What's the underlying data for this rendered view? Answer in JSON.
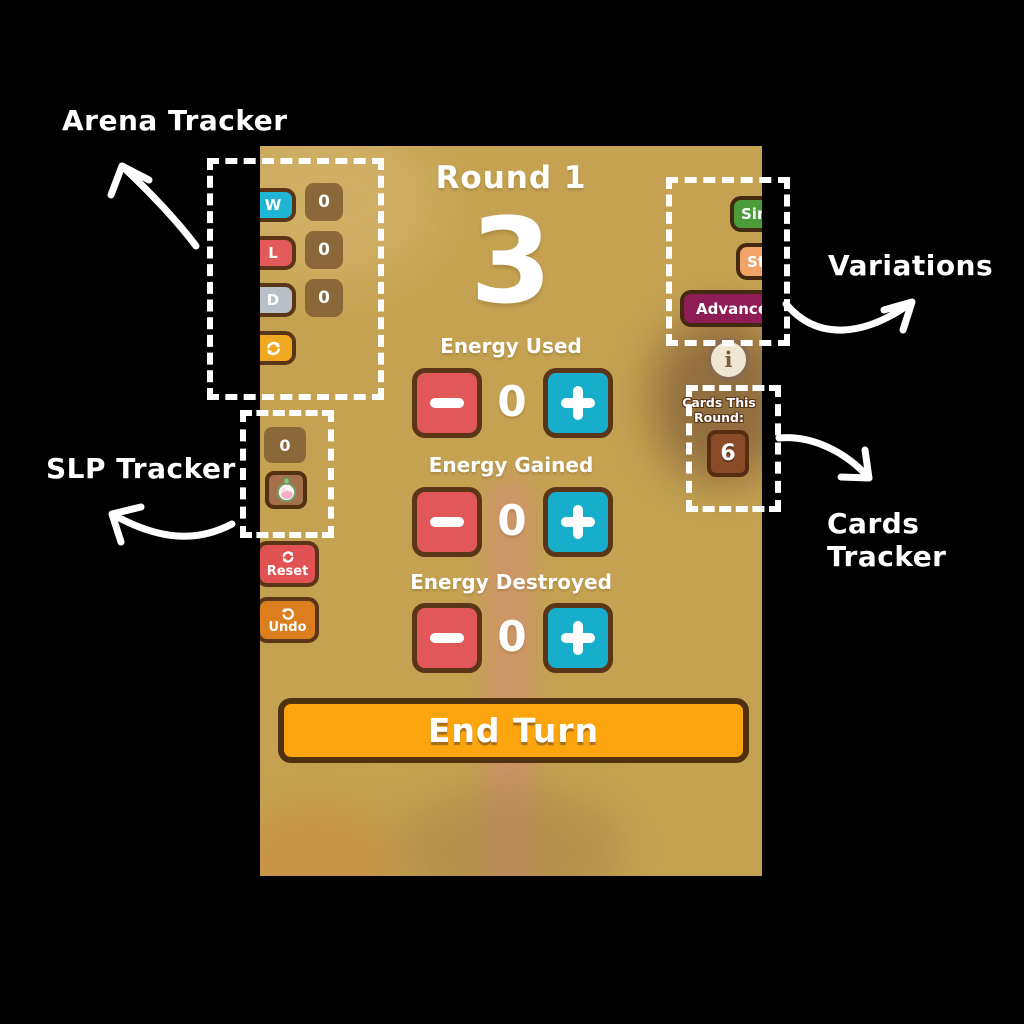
{
  "app": {
    "header": {
      "round_label": "Round 1",
      "energy_count": "3"
    },
    "arena": {
      "rows": [
        {
          "key": "W",
          "count": "0"
        },
        {
          "key": "L",
          "count": "0"
        },
        {
          "key": "D",
          "count": "0"
        }
      ]
    },
    "slp": {
      "count": "0"
    },
    "actions": {
      "reset": "Reset",
      "undo": "Undo"
    },
    "variations": {
      "sim": "Sim",
      "sta": "Sta",
      "advance": "Advance",
      "info": "i"
    },
    "cards": {
      "label": "Cards This Round:",
      "count": "6"
    },
    "energy_sections": [
      {
        "label": "Energy Used",
        "value": "0"
      },
      {
        "label": "Energy Gained",
        "value": "0"
      },
      {
        "label": "Energy Destroyed",
        "value": "0"
      }
    ],
    "end_turn": "End Turn"
  },
  "annotations": {
    "arena_tracker": "Arena Tracker",
    "slp_tracker": "SLP Tracker",
    "variations": "Variations",
    "cards_tracker": "Cards Tracker"
  },
  "colors": {
    "background_tan": "#C4A251",
    "win": "#1FB5D5",
    "loss": "#E25A5A",
    "draw": "#B9BFC7",
    "arena_refresh": "#F0A722",
    "counter_bg": "#8A6839",
    "border_brown": "#5A3517",
    "minus": "#E25757",
    "plus": "#17AECB",
    "reset": "#E25252",
    "undo": "#DD7E1E",
    "sim": "#4C9C3C",
    "sta": "#F2A468",
    "advance": "#8E1D56",
    "end_turn": "#FCA50F",
    "card_count_bg": "#8A4B28",
    "info_bg": "#EFE6D3",
    "annotation": "#FFFFFF"
  }
}
